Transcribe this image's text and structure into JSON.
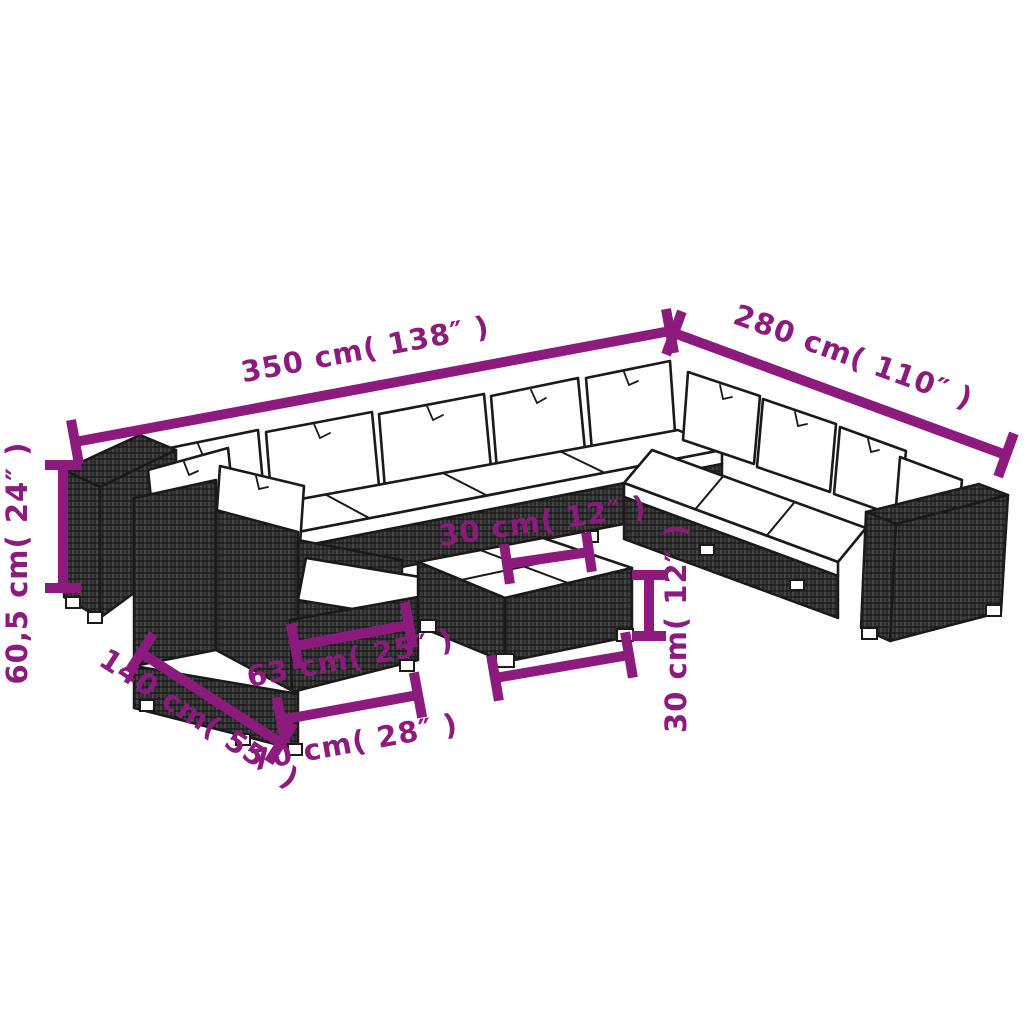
{
  "illustration": {
    "type": "product-dimension-line-drawing",
    "subject": "modular-rattan-garden-lounge-set-with-coffee-table"
  },
  "colors": {
    "background": "#FFFFFF",
    "dimension_accent": "#8D1B7D",
    "line_art": "#1A1A1A",
    "rattan_fill": "#2D2D2D",
    "cushion": "#FFFFFF"
  },
  "dimensions": {
    "back_width": {
      "label": "350 cm( 138″ )"
    },
    "right_width": {
      "label": "280 cm( 110″ )"
    },
    "height": {
      "label": "60,5 cm( 24″ )"
    },
    "wing_depth": {
      "label": "140 cm( 55″ )"
    },
    "seat_width": {
      "label": "63 cm( 25″ )"
    },
    "module_width": {
      "label": "70 cm( 28″ )"
    },
    "table_top": {
      "label": "30 cm( 12″ )"
    },
    "table_height": {
      "label": "30 cm( 12″ )"
    }
  }
}
